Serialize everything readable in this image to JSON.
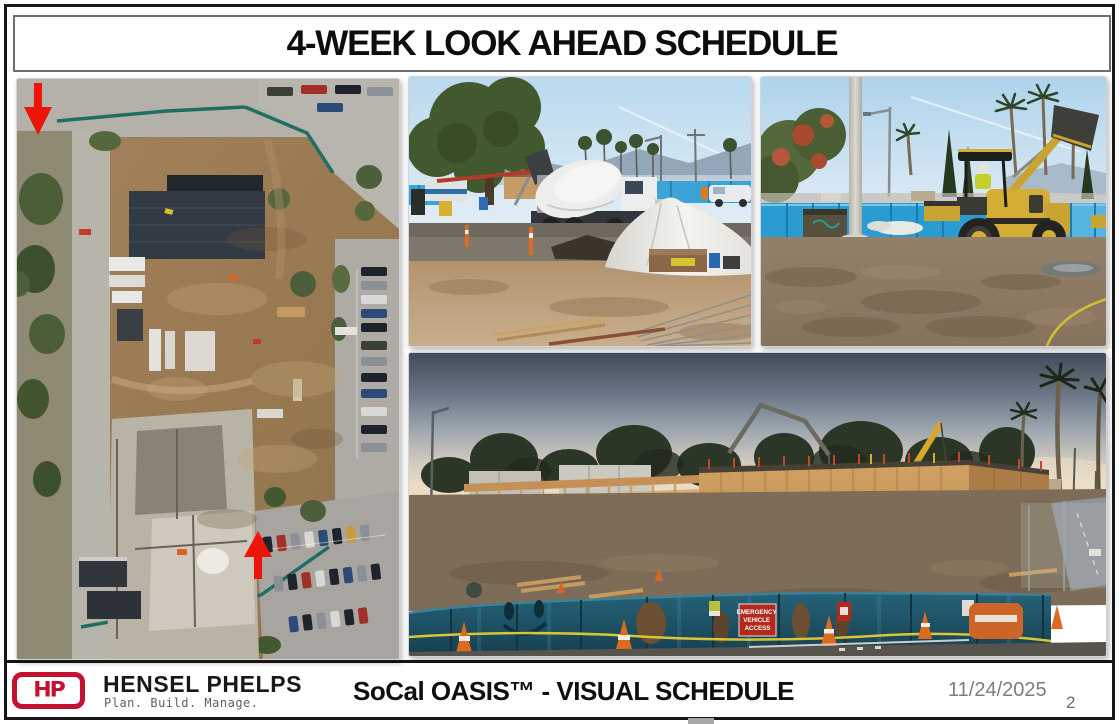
{
  "slide": {
    "title": "4-WEEK LOOK AHEAD SCHEDULE",
    "date": "11/24/2025",
    "page_number": "2"
  },
  "footer": {
    "logo_monogram": "HP",
    "brand_name": "HENSEL PHELPS",
    "brand_tagline": "Plan. Build. Manage.",
    "subtitle": "SoCal OASIS™ - VISUAL SCHEDULE"
  },
  "photos": {
    "framing": {
      "sign_lines": [
        "EMERGENCY",
        "VEHICLE",
        "ACCESS"
      ]
    }
  },
  "colors": {
    "brand_red": "#C31230",
    "arrow_red": "#EE1408",
    "site_fence_blue": "#2A9CD2",
    "screen_fence_teal": "#1E5D72",
    "date_gray": "#7D7D7D"
  }
}
